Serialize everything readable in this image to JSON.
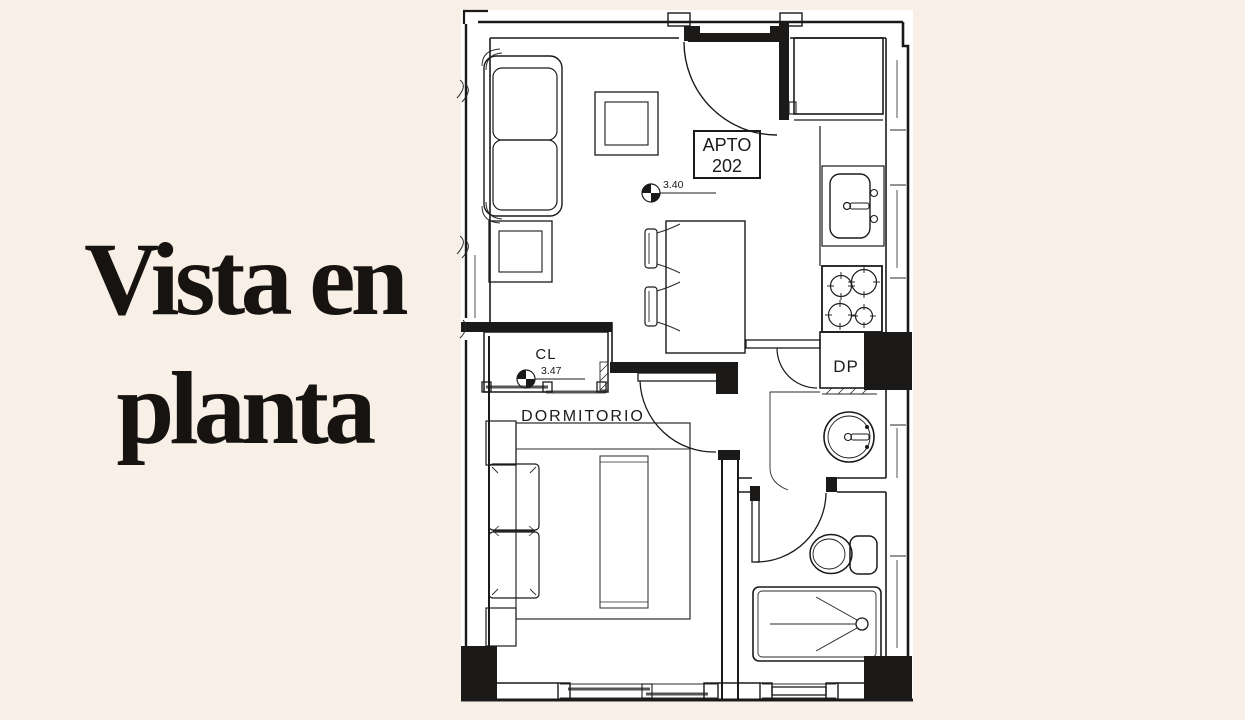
{
  "page": {
    "background_color": "#f8f0e7",
    "paper_color": "#ffffff",
    "line_color": "#1c1a18"
  },
  "title": {
    "line1": "Vista en",
    "line2": "planta"
  },
  "plan": {
    "unit_label_line1": "APTO",
    "unit_label_line2": "202",
    "bedroom_label": "DORMITORIO",
    "closet_label": "CL",
    "duct_label": "DP",
    "living_level": "3.40",
    "closet_level": "3.47"
  }
}
